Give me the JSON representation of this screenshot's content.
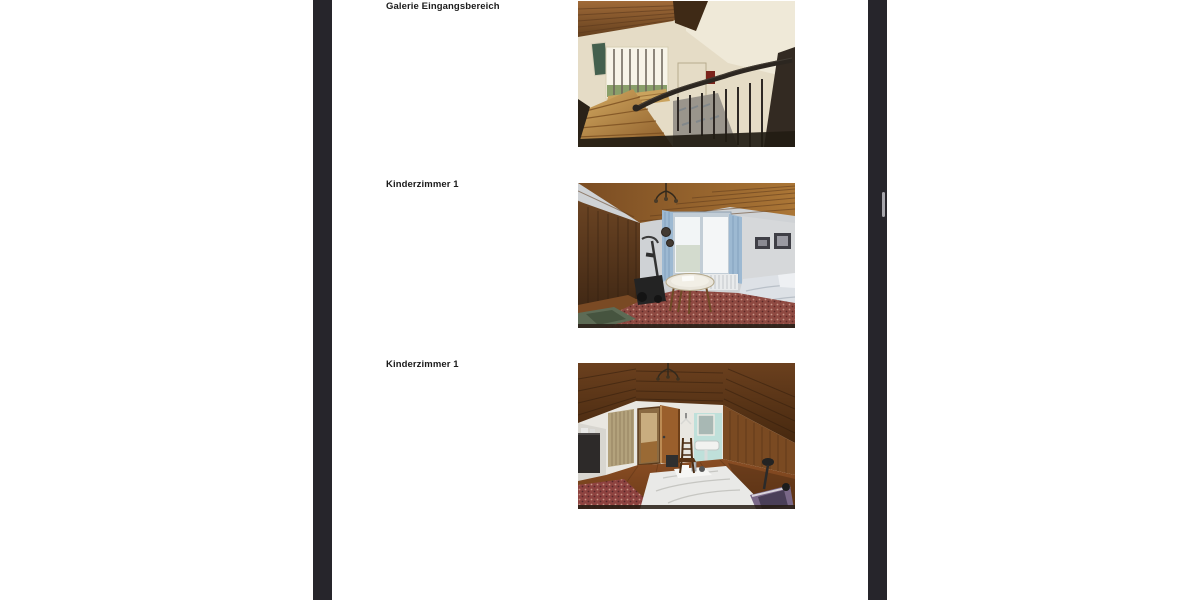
{
  "viewer": {
    "canvas_color": "#26252b",
    "page_color": "#ffffff",
    "scrollbar_thumb_color": "#a6a6ac"
  },
  "document": {
    "label_color": "#1b1b1b",
    "figures": [
      {
        "label": "Galerie Eingangsbereich",
        "photo": "gallery above entrance: wooden slat ceiling, barred skylight window, wooden staircase descending with dark curved banister"
      },
      {
        "label": "Kinderzimmer 1",
        "photo": "attic children's room: sloped wood ceiling, wood-paneled wall, window with light blue curtains, radiator, round table, exercise bike, red oriental carpet, bed at right"
      },
      {
        "label": "Kinderzimmer 1",
        "photo": "attic children's room second view: open wooden door, beige curtain, wash basin with mirror on teal tiles, wood floor, white bed, exercise bike, red carpet"
      }
    ]
  }
}
